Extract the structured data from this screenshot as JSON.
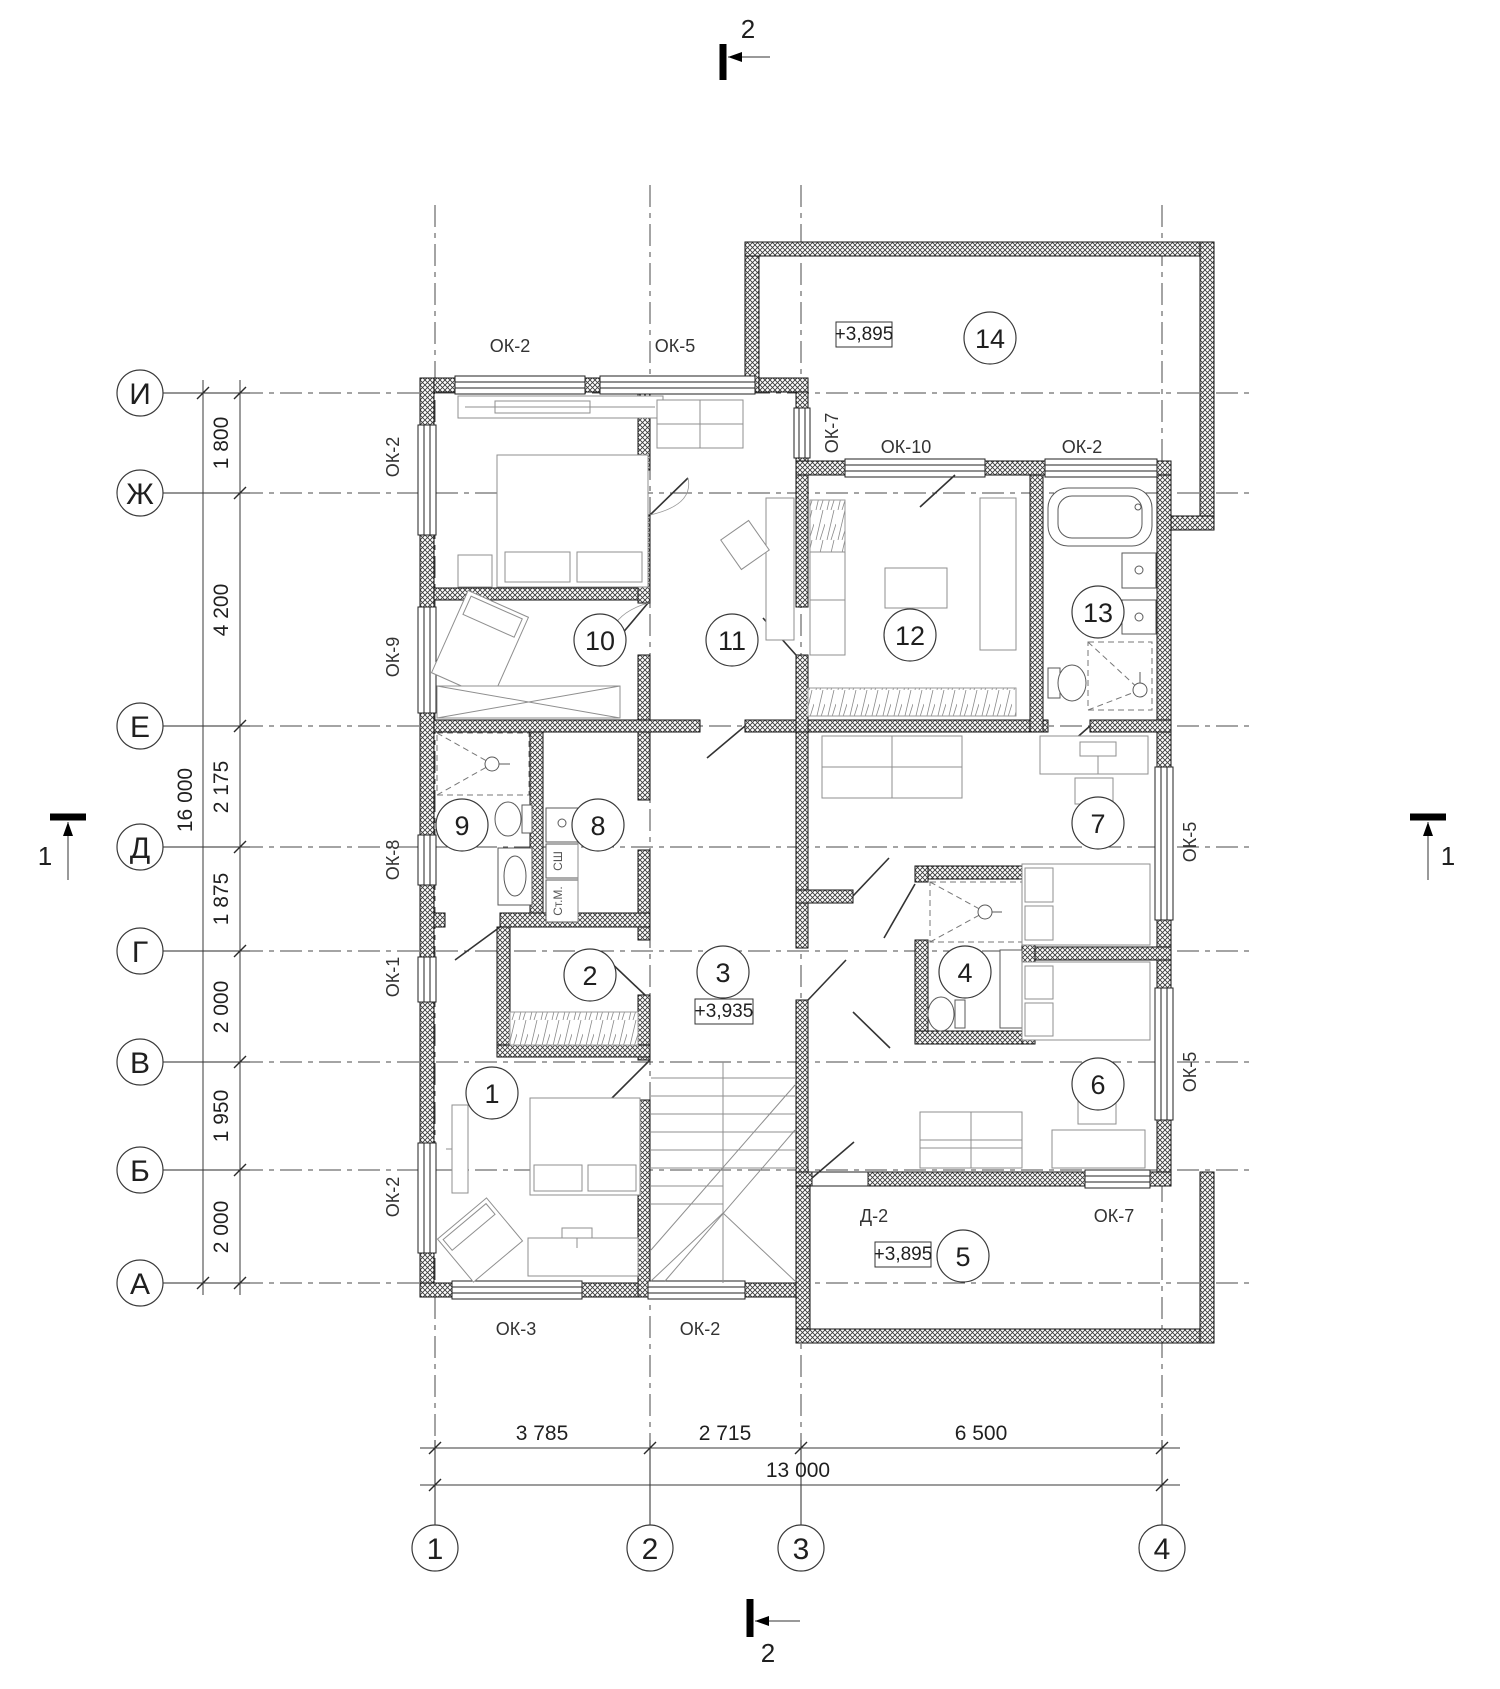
{
  "drawing_type": "architectural-floor-plan",
  "grid": {
    "rows": [
      "И",
      "Ж",
      "Е",
      "Д",
      "Г",
      "В",
      "Б",
      "А"
    ],
    "row_spacings": [
      "1 800",
      "4 200",
      "2 175",
      "1 875",
      "2 000",
      "1 950",
      "2 000"
    ],
    "row_total": "16 000",
    "cols": [
      "1",
      "2",
      "3",
      "4"
    ],
    "col_spacings": [
      "3 785",
      "2 715",
      "6 500"
    ],
    "col_total": "13 000"
  },
  "rooms": [
    "1",
    "2",
    "3",
    "4",
    "5",
    "6",
    "7",
    "8",
    "9",
    "10",
    "11",
    "12",
    "13",
    "14"
  ],
  "elevations": {
    "hall": "+3,935",
    "balcony": "+3,895",
    "terrace": "+3,895"
  },
  "windows": {
    "top": [
      "ОК-2",
      "ОК-5"
    ],
    "left": [
      "ОК-2",
      "ОК-9",
      "ОК-8",
      "ОК-1",
      "ОК-2"
    ],
    "bottom": [
      "ОК-3",
      "ОК-2"
    ],
    "north": [
      "ОК-7",
      "ОК-10",
      "ОК-2"
    ],
    "right": [
      "ОК-5",
      "ОК-5"
    ],
    "south": [
      "Д-2",
      "ОК-7"
    ]
  },
  "appliances": [
    "СШ",
    "Ст.М."
  ],
  "sections": {
    "top": "2",
    "bottom": "2",
    "left": "1",
    "right": "1"
  }
}
